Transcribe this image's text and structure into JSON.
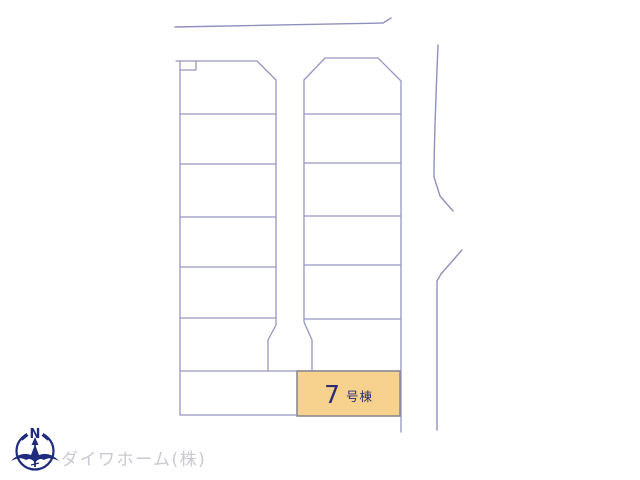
{
  "plan": {
    "line_color": "#9696C4",
    "road_line_color": "#9090BE",
    "lot": {
      "number": "7",
      "suffix": "号棟",
      "label": "7号棟",
      "fill": "#F7D28F",
      "border": "#8A8A94",
      "text_color": "#2C2C74"
    }
  },
  "footer": {
    "company": "ダイワホーム(株)",
    "company_color": "#C9C9D1",
    "compass": {
      "north": "N",
      "color": "#1F2B7C"
    }
  }
}
